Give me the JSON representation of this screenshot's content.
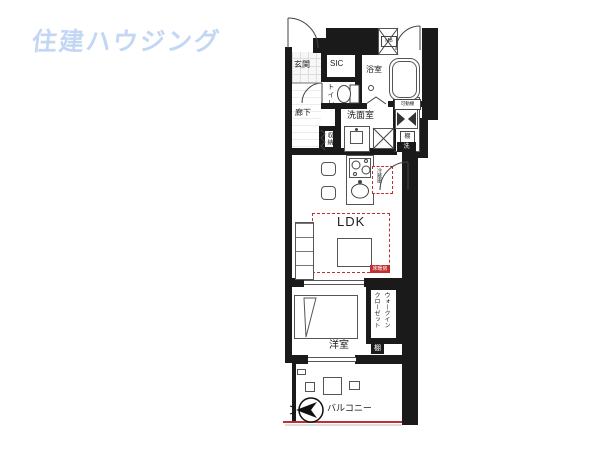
{
  "logo": {
    "text": "住建ハウジング",
    "color": "#c3d7f5"
  },
  "floorplan": {
    "colors": {
      "wall": "#1a1a1a",
      "line": "#555555",
      "accent_red": "#c03030"
    },
    "labels": {
      "genkan": "玄関",
      "sic": "SIC",
      "toilet": "トイレ",
      "bath": "浴室",
      "mb": "MB",
      "hallway": "廊下",
      "washroom": "洗面室",
      "storage": "収納",
      "movable_shelf": "可動棚",
      "shelf_right": "棚",
      "washer": "洗",
      "fridge": "冷蔵庫",
      "ldk": "LDK",
      "floor_heating": "床暖房",
      "bedroom": "洋室",
      "wic_line1": "ウォークイン",
      "wic_line2": "クローゼット",
      "shelf_bedroom": "棚",
      "balcony": "バルコニー"
    },
    "icons": [
      "compass-north-icon",
      "door-arc-icon",
      "bathtub-icon",
      "toilet-icon",
      "stove-icon",
      "sink-icon"
    ]
  }
}
